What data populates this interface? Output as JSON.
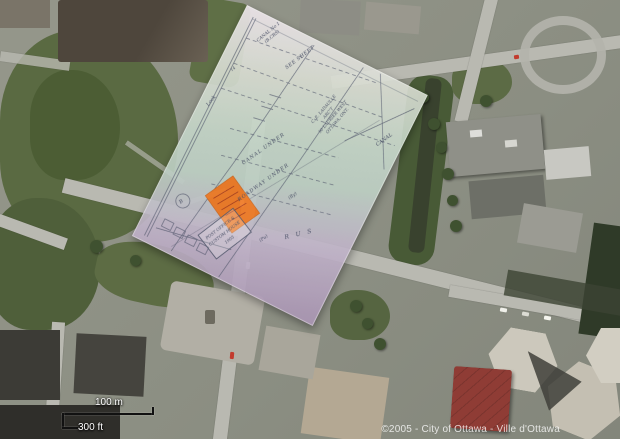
{
  "map": {
    "copyright": "©2005 - City of Ottawa - Ville d'Ottawa",
    "scale_bar": {
      "metric_label": "100 m",
      "imperial_label": "300 ft"
    }
  },
  "overlay_plan": {
    "labels": {
      "top_note_line1": "CANAL No 1",
      "top_note_line2": "(B.CRS)",
      "see_sheet": "SEE SHEET",
      "lock": "Lock",
      "canal_under": "CANAL UNDER",
      "roadway_under": "ROADWAY UNDER",
      "by_mark": "(By)",
      "pu_mark": "(Pu)",
      "rus_letters": "R U S",
      "canal_corner": "CANAL",
      "dim_number": "14",
      "stamp_circle": "B"
    },
    "architect_block": [
      "C. E. LADAULLE",
      "ARC'T",
      "90 LAURIER WEST",
      "OTTAWA, ONT."
    ],
    "stamp_box": [
      "POST OFFICE &",
      "CUSTOM HOUSE",
      "1905"
    ],
    "colors": {
      "highlight_orange": "#f0761e",
      "ink": "#3f4660",
      "paper_green": "#bfd2c4",
      "paper_mauve": "#a893b2"
    }
  },
  "base_map_colors": {
    "park": "#55663f",
    "water": "#39422e",
    "road": "#b9b9b1"
  }
}
